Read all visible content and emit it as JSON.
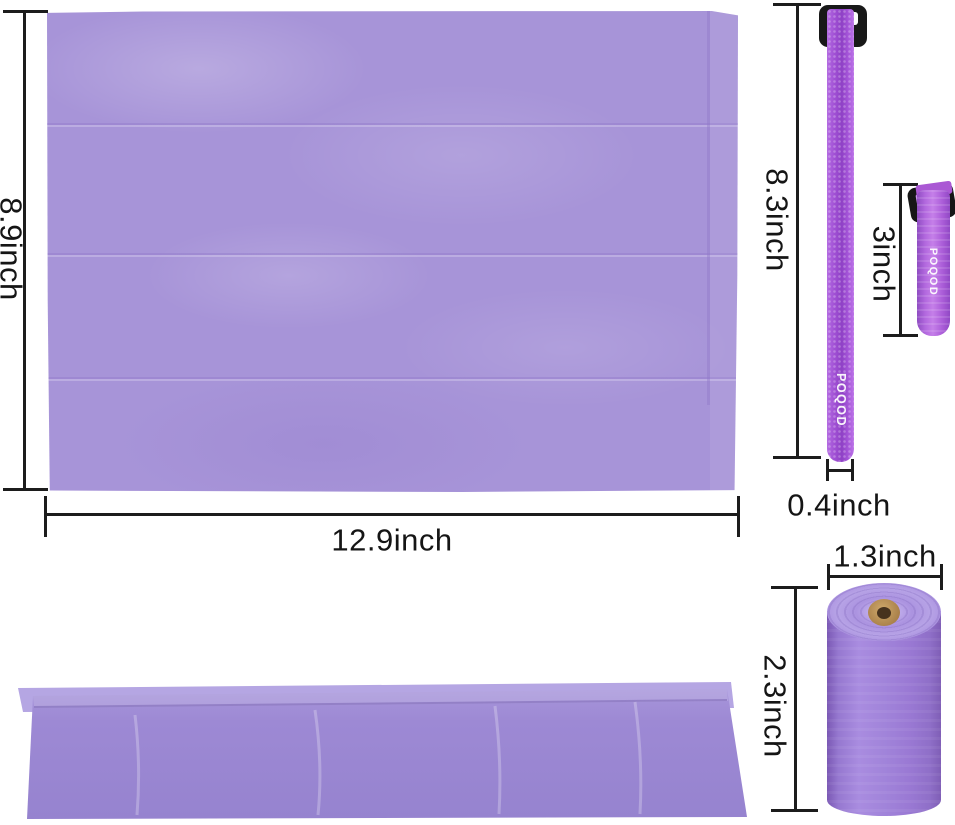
{
  "diagram": {
    "description": "Purple trash bag product dimension diagram",
    "labels": {
      "flat_bag_height": "8.9inch",
      "flat_bag_width": "12.9inch",
      "long_strap_length": "8.3inch",
      "long_strap_width": "0.4inch",
      "rolled_strap_length": "3inch",
      "roll_width": "1.3inch",
      "roll_height": "2.3inch"
    },
    "brand": {
      "long_strap": "POQOD",
      "rolled_strap": "POQOD"
    },
    "colors": {
      "background": "#ffffff",
      "dimension_line": "#1c1c1c",
      "label_text": "#151515",
      "bag_purple": "#a794d8",
      "strip_purple": "#9d89d4",
      "strap_purple": "#a050d4",
      "small_strap_purple": "#b268de",
      "roll_purple": "#9d7ed6",
      "roll_core_tan": "#a87f48",
      "buckle_black": "#181818",
      "brand_text": "#ffffff"
    }
  }
}
